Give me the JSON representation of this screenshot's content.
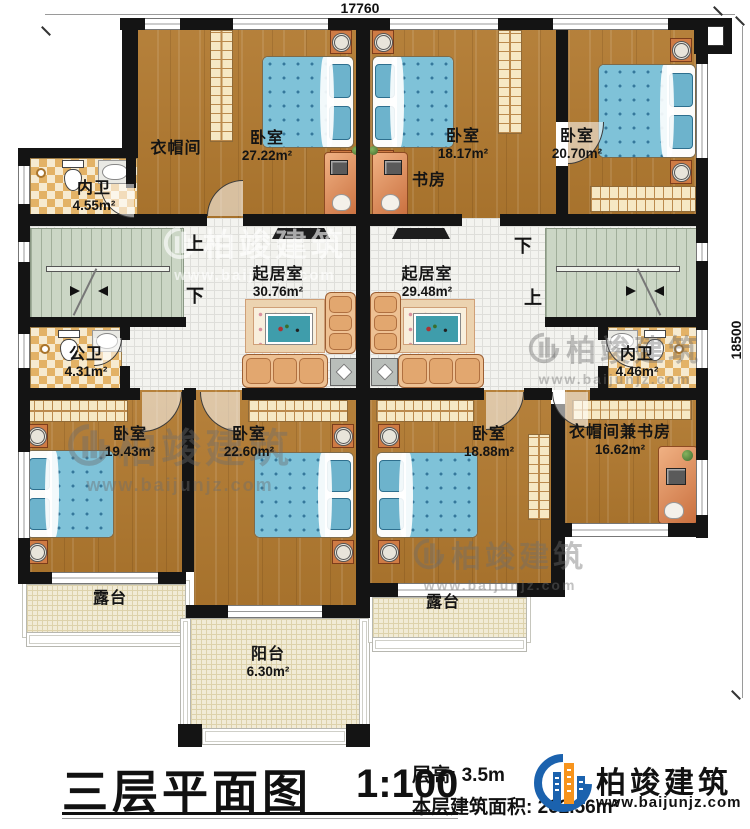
{
  "dimensions": {
    "width_mm": "17760",
    "height_mm": "18500"
  },
  "rooms": [
    {
      "name": "衣帽间",
      "area": ""
    },
    {
      "name": "卧室",
      "area": "27.22m²"
    },
    {
      "name": "卧室",
      "area": "18.17m²"
    },
    {
      "name": "卧室",
      "area": "20.70m²"
    },
    {
      "name": "书房",
      "area": ""
    },
    {
      "name": "内卫",
      "area": "4.55m²"
    },
    {
      "name": "起居室",
      "area": "30.76m²"
    },
    {
      "name": "起居室",
      "area": "29.48m²"
    },
    {
      "name": "公卫",
      "area": "4.31m²"
    },
    {
      "name": "内卫",
      "area": "4.46m²"
    },
    {
      "name": "卧室",
      "area": "19.43m²"
    },
    {
      "name": "卧室",
      "area": "22.60m²"
    },
    {
      "name": "卧室",
      "area": "18.88m²"
    },
    {
      "name": "衣帽间兼书房",
      "area": "16.62m²"
    },
    {
      "name": "露台",
      "area": ""
    },
    {
      "name": "露台",
      "area": ""
    },
    {
      "name": "阳台",
      "area": "6.30m²"
    }
  ],
  "stairs": {
    "up": "上",
    "down": "下"
  },
  "titleblock": {
    "title": "三层平面图",
    "scale": "1:100",
    "floor_height": "层高: 3.5m",
    "floor_area": "本层建筑面积: 262.56m²"
  },
  "brand": {
    "name": "柏竣建筑",
    "url": "www.baijunjz.com"
  }
}
